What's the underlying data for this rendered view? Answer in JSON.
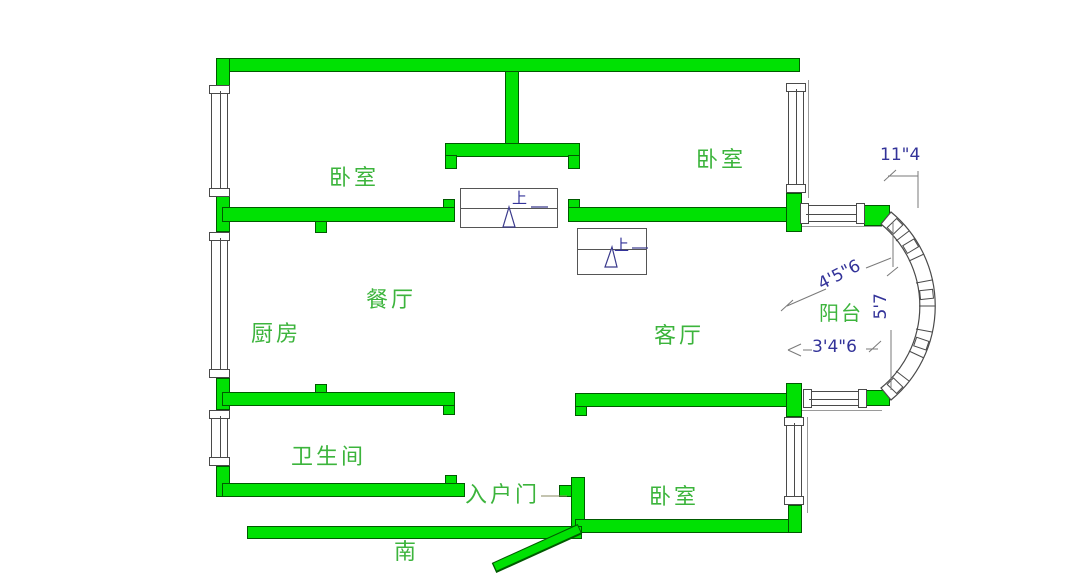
{
  "rooms": {
    "bedroom_top_left": "卧室",
    "bedroom_top_right": "卧室",
    "bedroom_bottom": "卧室",
    "dining": "餐厅",
    "kitchen": "厨房",
    "living": "客厅",
    "bathroom": "卫生间",
    "balcony": "阳台",
    "entrance_door": "入户门"
  },
  "compass": {
    "south": "南"
  },
  "dimensions": {
    "top_right": "11\"4",
    "balcony_upper": "4'5\"6",
    "balcony_depth": "5'7",
    "balcony_lower": "3'4\"6"
  },
  "stairs": {
    "up": "上"
  },
  "colors": {
    "wall_fill": "#00e103",
    "wall_edge": "#005a00",
    "room_label": "#3cb43c",
    "dimension_text": "#333399",
    "symbol_line": "#4a4a4a"
  }
}
